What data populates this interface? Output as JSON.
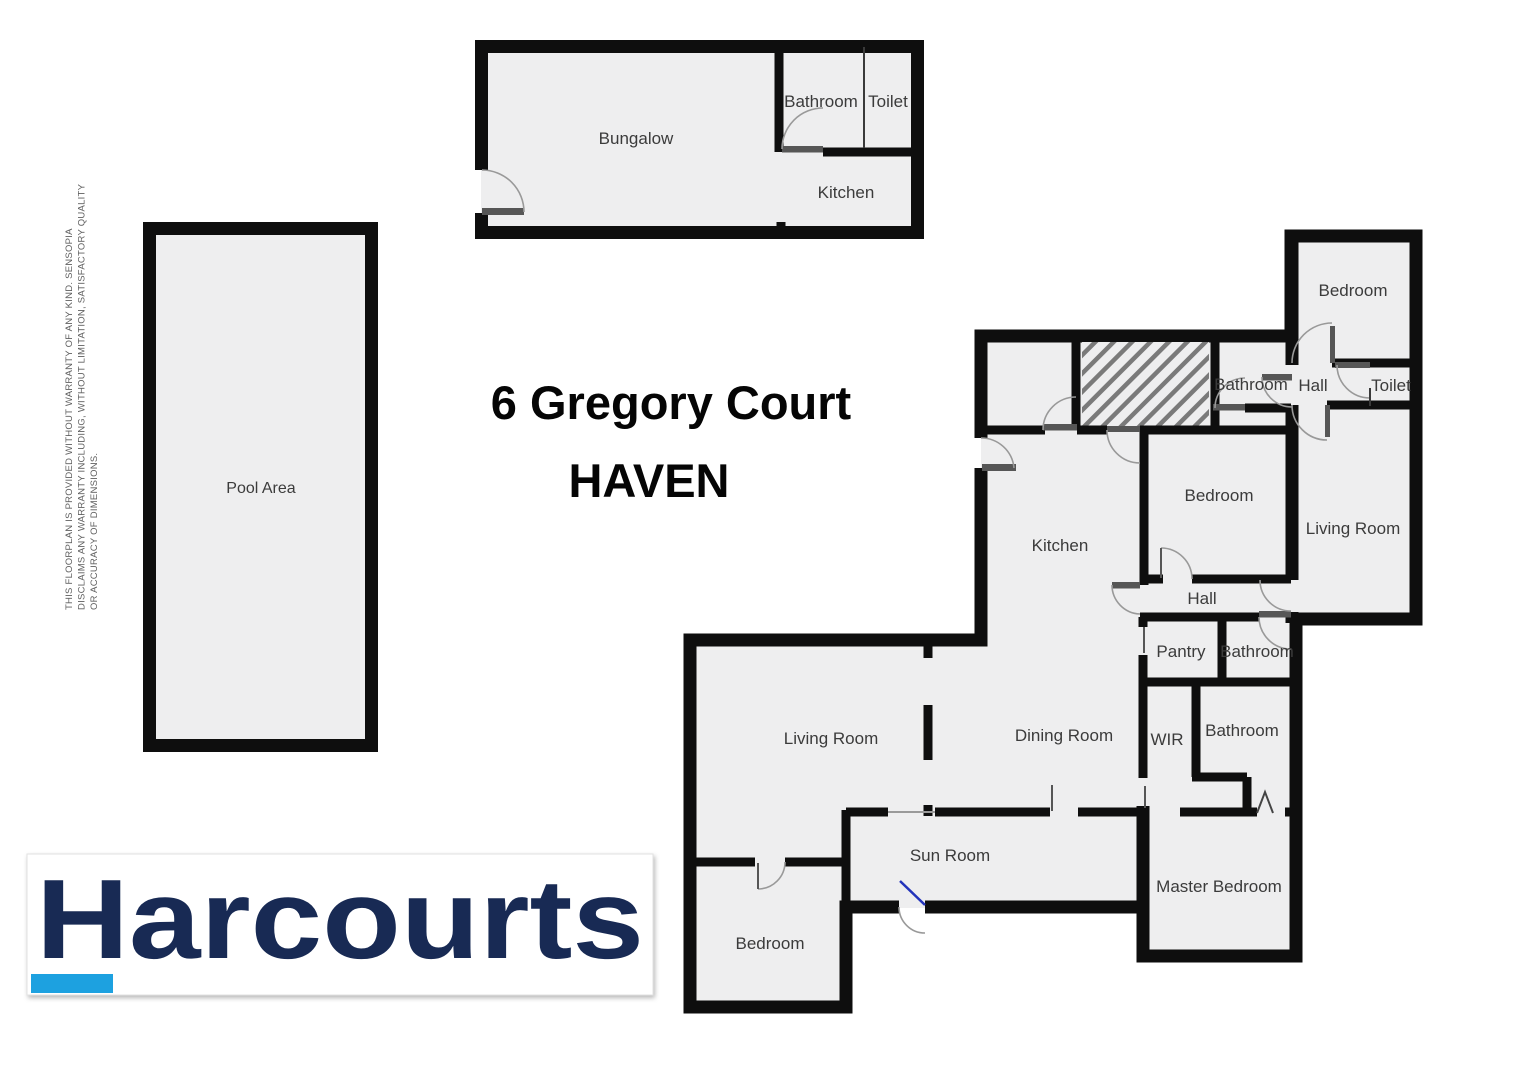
{
  "title": {
    "line1": "6 Gregory Court",
    "line2": "HAVEN"
  },
  "disclaimer": {
    "line1": "THIS FLOORPLAN IS PROVIDED WITHOUT WARRANTY OF ANY KIND. SENSOPIA",
    "line2": "DISCLAIMS ANY WARRANTY INCLUDING, WITHOUT LIMITATION, SATISFACTORY QUALITY",
    "line3": "OR ACCURACY OF DIMENSIONS."
  },
  "logo": {
    "brand": "Harcourts"
  },
  "colors": {
    "wall": "#0e0e0e",
    "floor": "#eeeeef",
    "door_sill": "#565656",
    "door_arc": "#999999",
    "hatch_stripe": "#7a7a7a",
    "label": "#3b3b3b",
    "logo_navy": "#182a54",
    "logo_cyan": "#1da1e0",
    "blue_door": "#2233bb"
  },
  "labels": {
    "bungalow": "Bungalow",
    "bungalow_bathroom": "Bathroom",
    "bungalow_toilet": "Toilet",
    "bungalow_kitchen": "Kitchen",
    "pool_area": "Pool Area",
    "bedroom_ne": "Bedroom",
    "bathroom_n": "Bathroom",
    "hall_n": "Hall",
    "toilet_n": "Toilet",
    "kitchen": "Kitchen",
    "bedroom_c": "Bedroom",
    "living_room_e": "Living Room",
    "hall_c": "Hall",
    "pantry": "Pantry",
    "bathroom_c": "Bathroom",
    "living_room_w": "Living Room",
    "dining_room": "Dining Room",
    "wir": "WIR",
    "bathroom_s": "Bathroom",
    "sun_room": "Sun Room",
    "master_bedroom": "Master Bedroom",
    "bedroom_sw": "Bedroom"
  }
}
